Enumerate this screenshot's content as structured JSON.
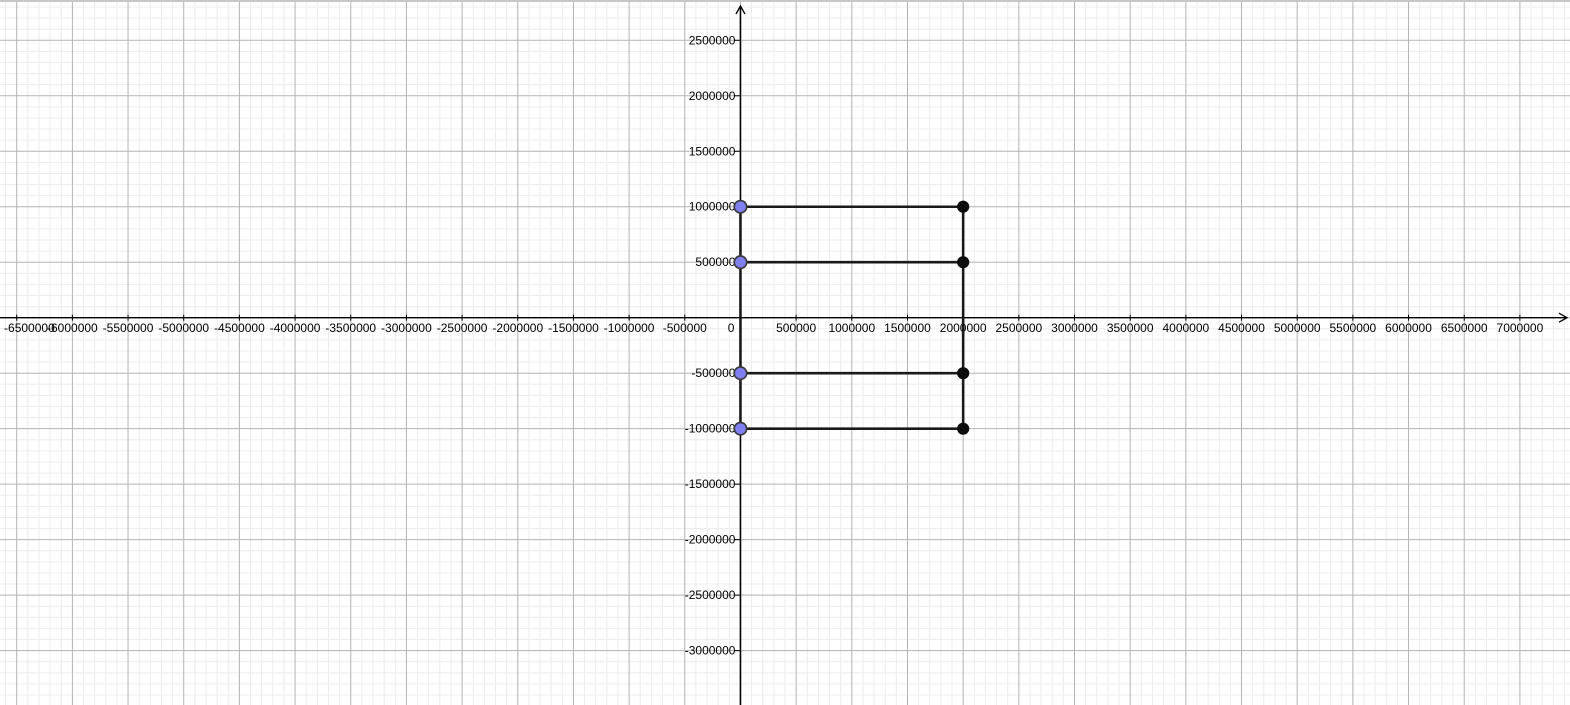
{
  "app": {
    "view_name": "graphics-view"
  },
  "chart_data": {
    "type": "scatter",
    "title": "",
    "xlabel": "",
    "ylabel": "",
    "grid": {
      "visible": true,
      "major_step": 500000,
      "minor_step": 100000,
      "major_color": "#b3b3b3",
      "minor_color": "#ececec"
    },
    "view": {
      "x_range": [
        -6650000,
        7450000
      ],
      "y_range": [
        -3490000,
        2845000
      ]
    },
    "x_tick_values": [
      -6500000,
      -6000000,
      -5500000,
      -5000000,
      -4500000,
      -4000000,
      -3500000,
      -3000000,
      -2500000,
      -2000000,
      -1500000,
      -1000000,
      -500000,
      0,
      500000,
      1000000,
      1500000,
      2000000,
      2500000,
      3000000,
      3500000,
      4000000,
      4500000,
      5000000,
      5500000,
      6000000,
      6500000,
      7000000
    ],
    "x_tick_labels": [
      "-6500000",
      "-6000000",
      "-5500000",
      "-5000000",
      "-4500000",
      "-4000000",
      "-3500000",
      "-3000000",
      "-2500000",
      "-2000000",
      "-1500000",
      "-1000000",
      "-500000",
      "0",
      "500000",
      "1000000",
      "1500000",
      "2000000",
      "2500000",
      "3000000",
      "3500000",
      "4000000",
      "4500000",
      "5000000",
      "5500000",
      "6000000",
      "6500000",
      "7000000"
    ],
    "y_tick_values": [
      2500000,
      2000000,
      1500000,
      1000000,
      500000,
      -500000,
      -1000000,
      -1500000,
      -2000000,
      -2500000,
      -3000000
    ],
    "y_tick_labels": [
      "2500000",
      "2000000",
      "1500000",
      "1000000",
      "500000",
      "-500000",
      "-1000000",
      "-1500000",
      "-2000000",
      "-2500000",
      "-3000000"
    ],
    "axes": {
      "color": "#000000",
      "x_arrow": "right",
      "y_arrow": "up"
    },
    "segments": [
      {
        "from": [
          0,
          1000000
        ],
        "to": [
          2000000,
          1000000
        ]
      },
      {
        "from": [
          0,
          500000
        ],
        "to": [
          2000000,
          500000
        ]
      },
      {
        "from": [
          0,
          -500000
        ],
        "to": [
          2000000,
          -500000
        ]
      },
      {
        "from": [
          0,
          -1000000
        ],
        "to": [
          2000000,
          -1000000
        ]
      },
      {
        "from": [
          0,
          1000000
        ],
        "to": [
          0,
          -1000000
        ]
      },
      {
        "from": [
          2000000,
          1000000
        ],
        "to": [
          2000000,
          -1000000
        ]
      }
    ],
    "segment_style": {
      "color": "#1a1a1a",
      "width": 2.6
    },
    "free_points": [
      {
        "x": 0,
        "y": 1000000
      },
      {
        "x": 0,
        "y": 500000
      },
      {
        "x": 0,
        "y": -500000
      },
      {
        "x": 0,
        "y": -1000000
      }
    ],
    "free_point_style": {
      "fill": "#7f7ff0",
      "stroke": "#3b3b3b",
      "radius": 6.2
    },
    "dependent_points": [
      {
        "x": 2000000,
        "y": 1000000
      },
      {
        "x": 2000000,
        "y": 500000
      },
      {
        "x": 2000000,
        "y": -500000
      },
      {
        "x": 2000000,
        "y": -1000000
      }
    ],
    "dependent_point_style": {
      "fill": "#0d0d0d",
      "stroke": "#0d0d0d",
      "radius": 5.6
    }
  }
}
